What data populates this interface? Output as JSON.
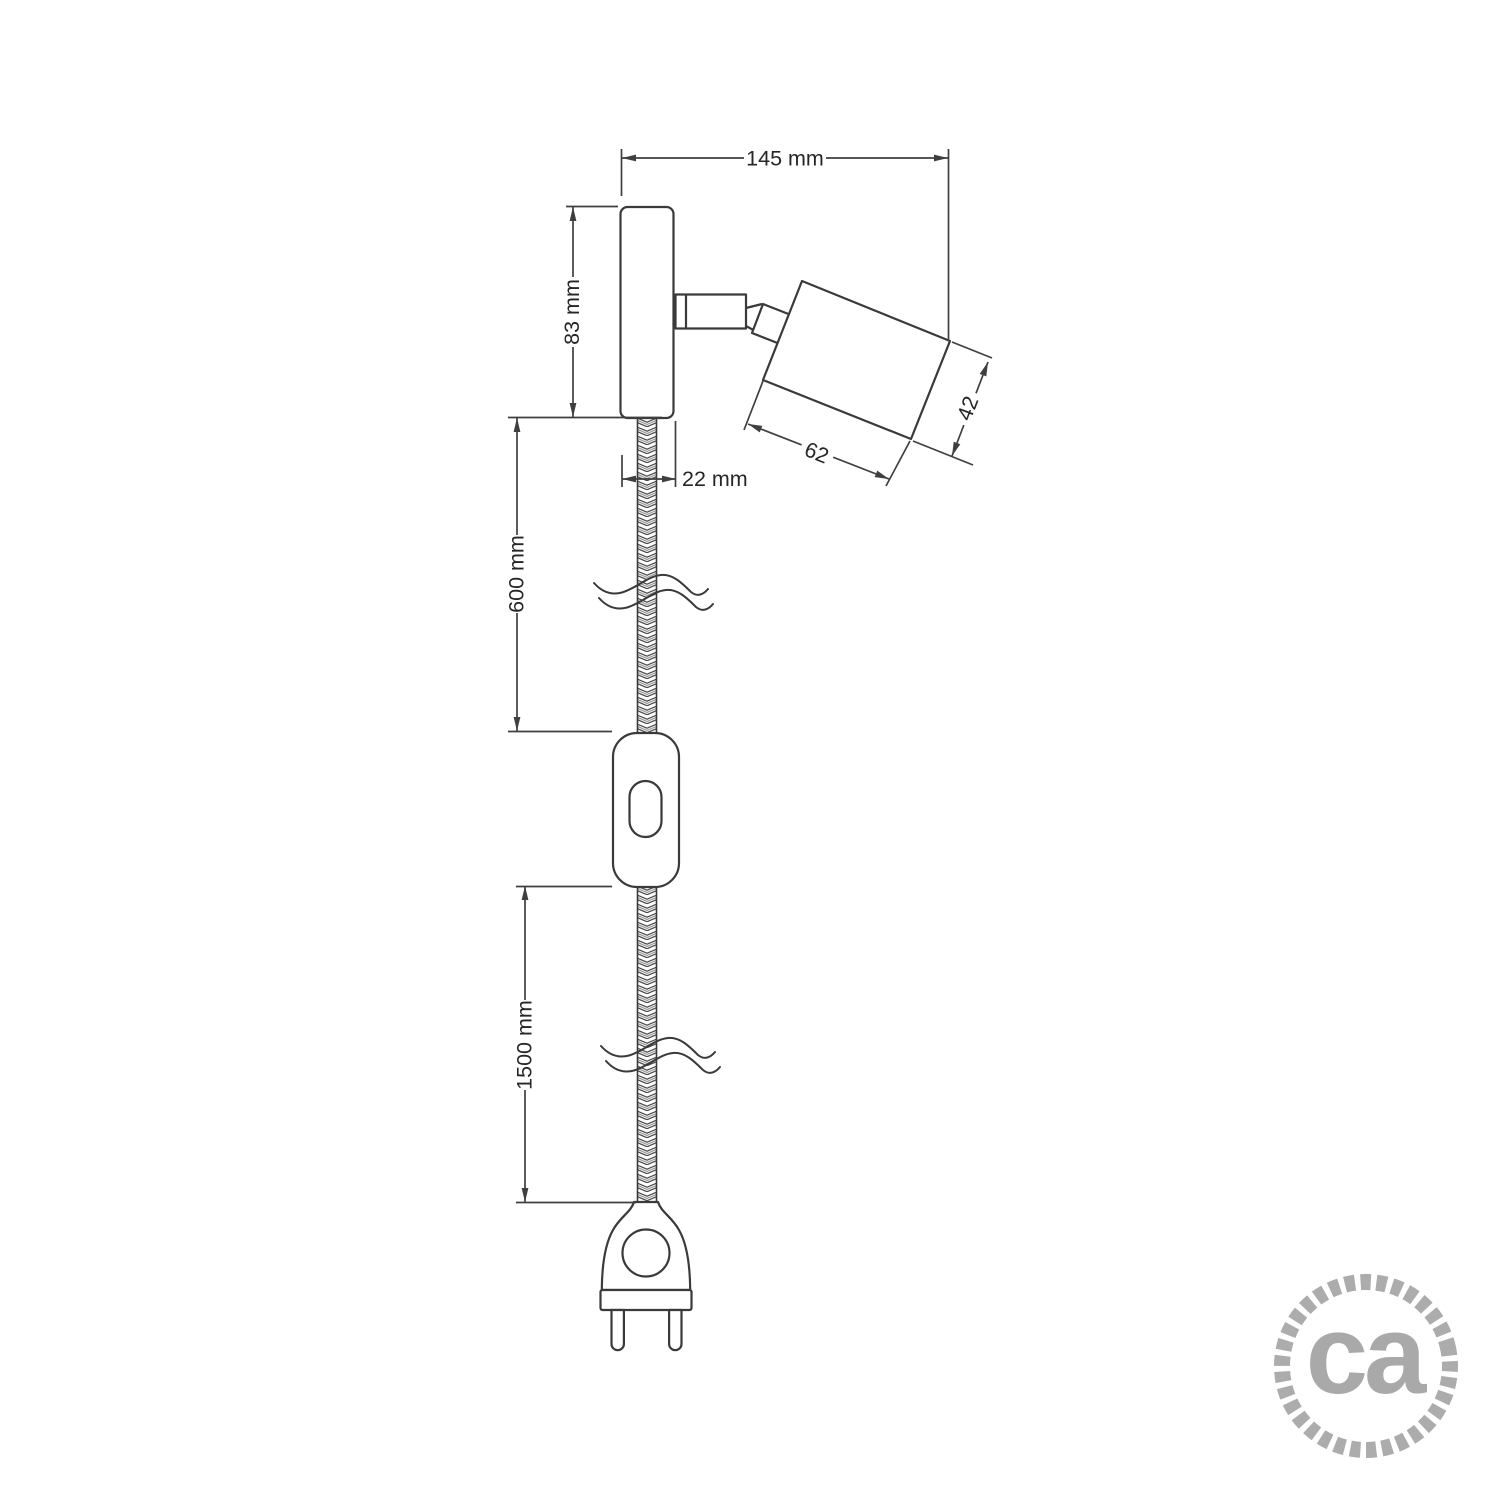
{
  "page": {
    "background_color": "#ffffff",
    "line_color": "#3a3a3a",
    "text_color": "#262626"
  },
  "drawing": {
    "description": "dimensional side-view drawing of a wall spotlight with plug-in braided cable",
    "dimensions": {
      "overall_width": {
        "label": "145 mm",
        "value": 145,
        "unit": "mm"
      },
      "plate_height": {
        "label": "83 mm",
        "value": 83,
        "unit": "mm"
      },
      "plate_depth": {
        "label": "22 mm",
        "value": 22,
        "unit": "mm"
      },
      "cable_upper_length": {
        "label": "600 mm",
        "value": 600,
        "unit": "mm"
      },
      "holder_length": {
        "label": "62",
        "value": 62,
        "unit": "mm"
      },
      "holder_diameter": {
        "label": "42",
        "value": 42,
        "unit": "mm"
      },
      "cable_lower_length": {
        "label": "1500 mm",
        "value": 1500,
        "unit": "mm"
      }
    },
    "parts": [
      "wall-mount-plate",
      "swivel-joint",
      "cylindrical-lamp-holder",
      "braided-cable-upper",
      "inline-switch",
      "braided-cable-lower",
      "two-pin-plug"
    ]
  },
  "logo": {
    "text": "ca",
    "text_color": "#a9a9a9",
    "ring_color": "#acacac"
  }
}
